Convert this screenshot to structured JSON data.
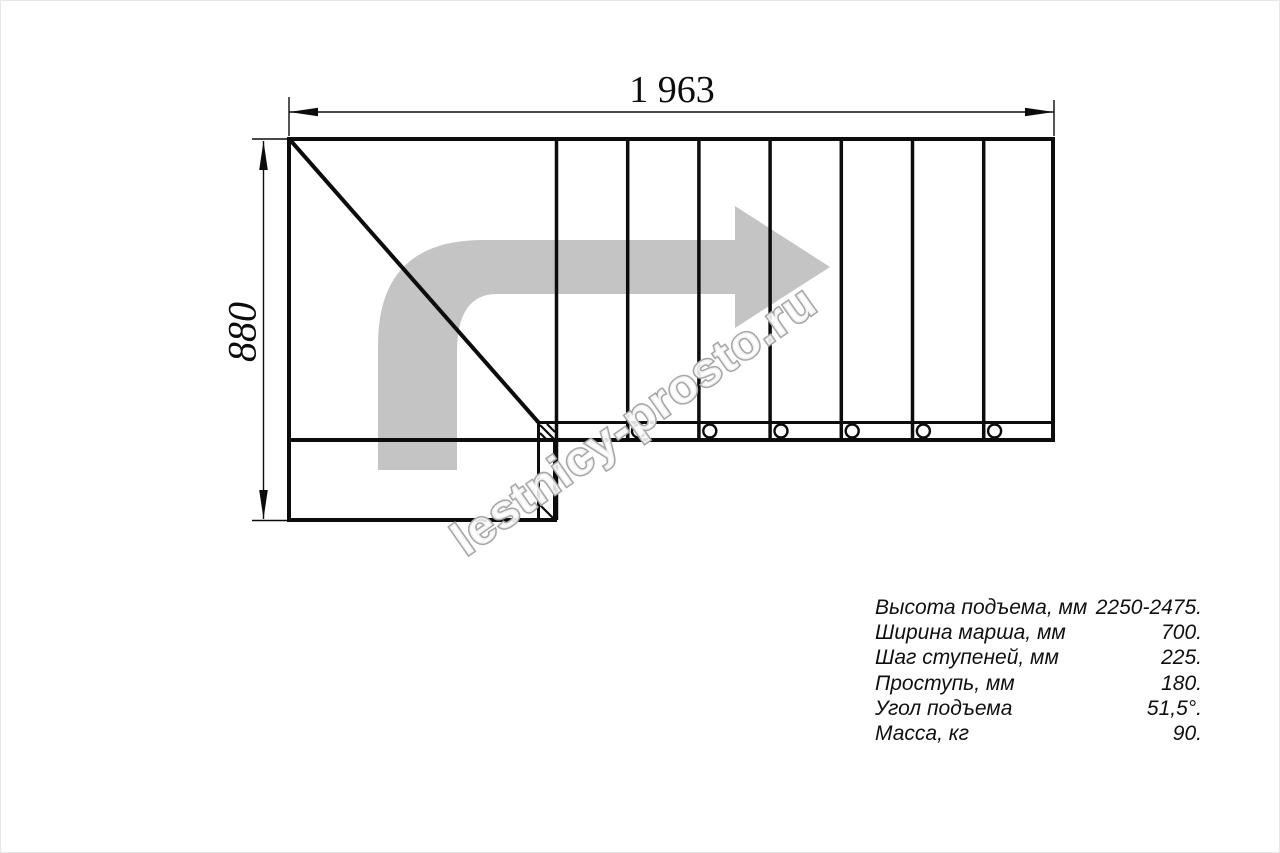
{
  "dimensions": {
    "width_label": "1 963",
    "height_label": "880"
  },
  "watermark": {
    "text": "lestnicy-prosto.ru"
  },
  "icons": {
    "direction_arrow": "turn-right-arrow"
  },
  "colors": {
    "line": "#0c0c0c",
    "arrow": "#c4c4c4",
    "watermark_stroke": "#a6a6a6"
  },
  "specs": {
    "rows": [
      {
        "label": "Высота подъема, мм",
        "value": "2250-2475."
      },
      {
        "label": "Ширина марша, мм",
        "value": "700."
      },
      {
        "label": "Шаг ступеней, мм",
        "value": "225."
      },
      {
        "label": "Проступь, мм",
        "value": "180."
      },
      {
        "label": "Угол подъема",
        "value": "51,5°."
      },
      {
        "label": "Масса, кг",
        "value": "90."
      }
    ]
  }
}
